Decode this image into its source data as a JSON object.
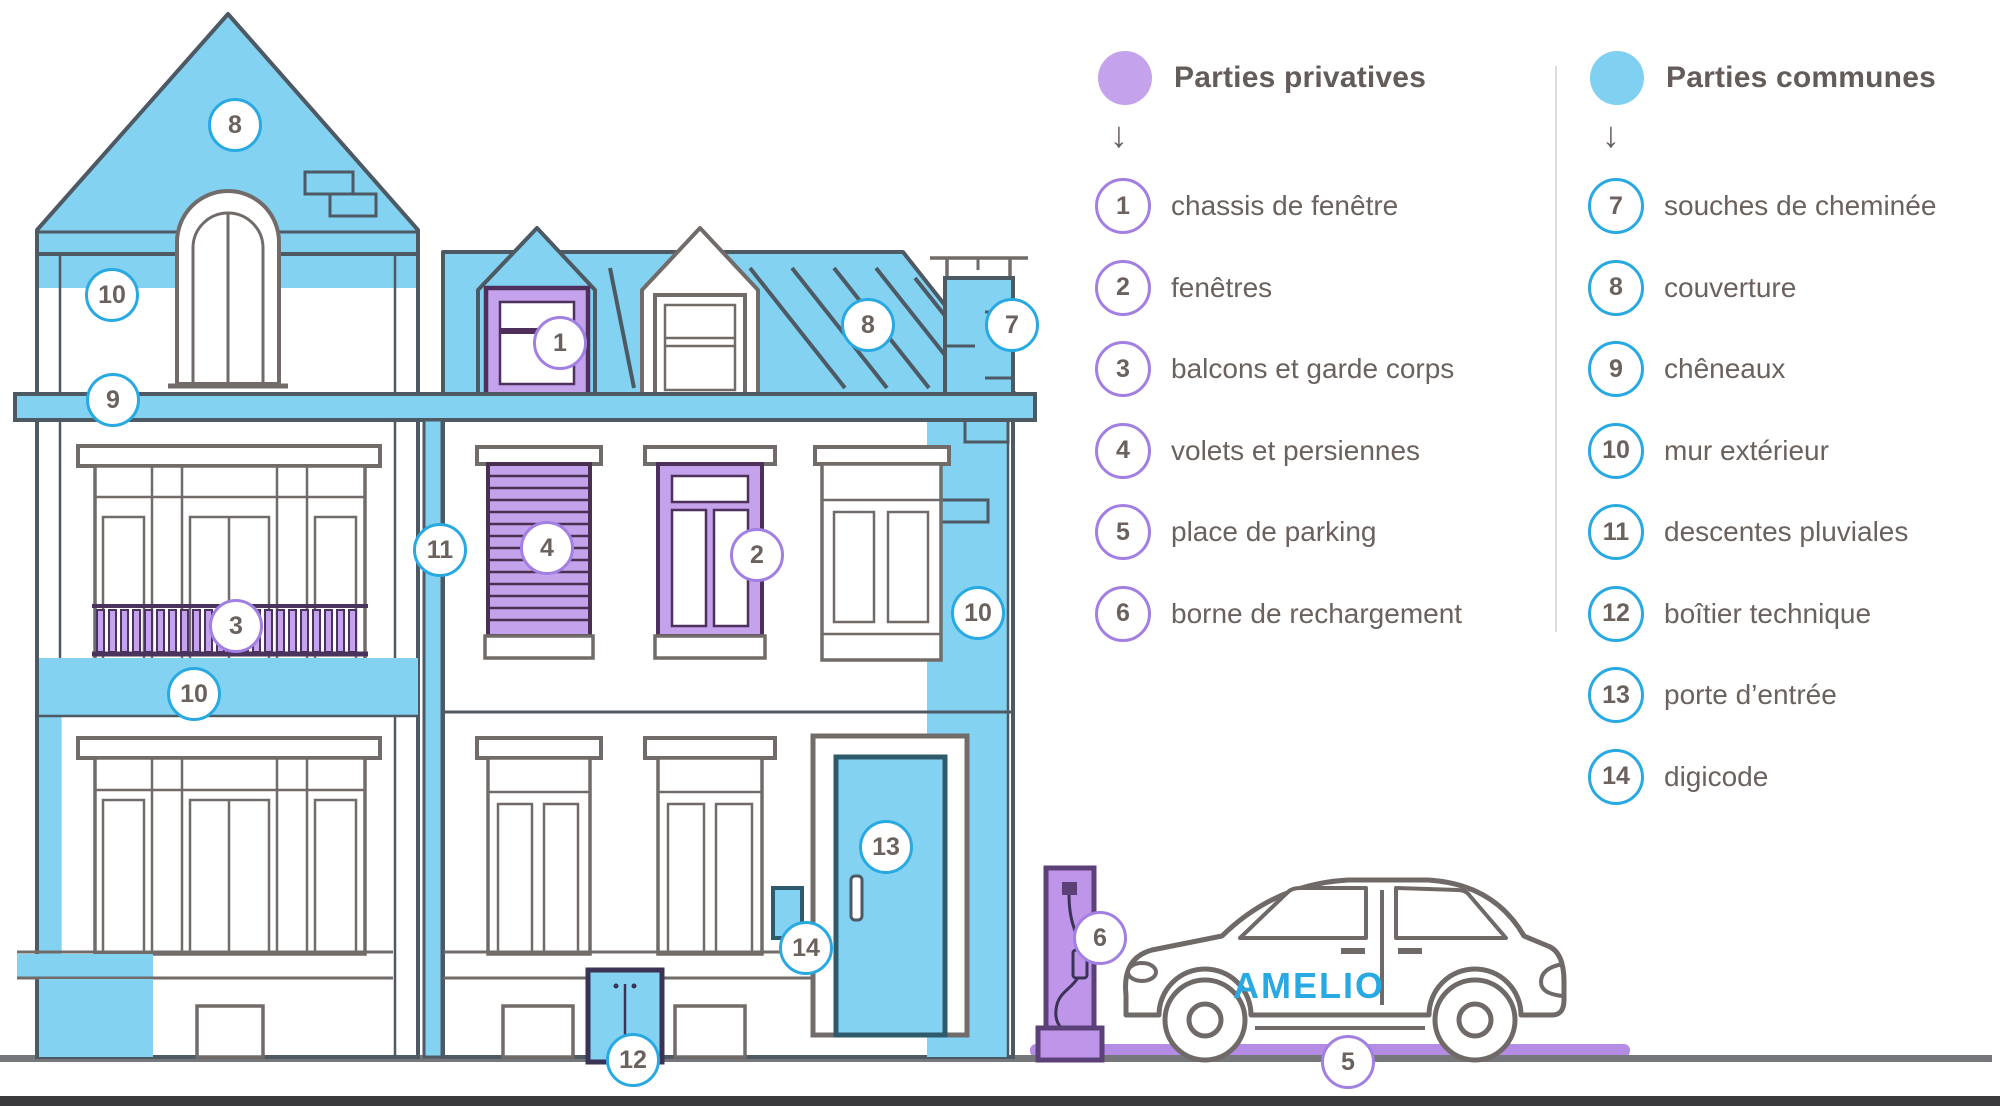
{
  "colors": {
    "common_blue": "#84D2F2",
    "private_purple": "#C5A3EC",
    "ring_blue": "#29A9E2",
    "ring_purple": "#A27FE3",
    "outline_slate": "#4D5A64",
    "outline_gray": "#716C69",
    "text_gray": "#6B625E",
    "brand_blue": "#29A9E1",
    "parking_purple": "#B58CE4"
  },
  "legend": {
    "private": {
      "title": "Parties privatives",
      "arrow": "↓",
      "items": [
        {
          "n": "1",
          "label": "chassis de fenêtre"
        },
        {
          "n": "2",
          "label": "fenêtres"
        },
        {
          "n": "3",
          "label": "balcons et garde corps"
        },
        {
          "n": "4",
          "label": "volets et persiennes"
        },
        {
          "n": "5",
          "label": "place de parking"
        },
        {
          "n": "6",
          "label": "borne de rechargement"
        }
      ]
    },
    "common": {
      "title": "Parties communes",
      "arrow": "↓",
      "items": [
        {
          "n": "7",
          "label": "souches de cheminée"
        },
        {
          "n": "8",
          "label": "couverture"
        },
        {
          "n": "9",
          "label": "chêneaux"
        },
        {
          "n": "10",
          "label": "mur extérieur"
        },
        {
          "n": "11",
          "label": "descentes pluviales"
        },
        {
          "n": "12",
          "label": "boîtier technique"
        },
        {
          "n": "13",
          "label": "porte d’entrée"
        },
        {
          "n": "14",
          "label": "digicode"
        }
      ]
    }
  },
  "car": {
    "brand": "AMELIO"
  },
  "badges": [
    {
      "n": "1",
      "x": 560,
      "y": 343,
      "t": "private"
    },
    {
      "n": "2",
      "x": 757,
      "y": 555,
      "t": "private"
    },
    {
      "n": "3",
      "x": 236,
      "y": 626,
      "t": "private"
    },
    {
      "n": "4",
      "x": 547,
      "y": 548,
      "t": "private"
    },
    {
      "n": "5",
      "x": 1348,
      "y": 1062,
      "t": "private"
    },
    {
      "n": "6",
      "x": 1100,
      "y": 938,
      "t": "private"
    },
    {
      "n": "7",
      "x": 1012,
      "y": 325,
      "t": "common"
    },
    {
      "n": "8",
      "x": 235,
      "y": 125,
      "t": "common"
    },
    {
      "n": "8",
      "x": 868,
      "y": 325,
      "t": "common"
    },
    {
      "n": "9",
      "x": 113,
      "y": 400,
      "t": "common"
    },
    {
      "n": "10",
      "x": 112,
      "y": 295,
      "t": "common"
    },
    {
      "n": "10",
      "x": 194,
      "y": 694,
      "t": "common"
    },
    {
      "n": "10",
      "x": 978,
      "y": 613,
      "t": "common"
    },
    {
      "n": "11",
      "x": 440,
      "y": 550,
      "t": "common"
    },
    {
      "n": "12",
      "x": 633,
      "y": 1060,
      "t": "common"
    },
    {
      "n": "13",
      "x": 886,
      "y": 847,
      "t": "common"
    },
    {
      "n": "14",
      "x": 806,
      "y": 948,
      "t": "common"
    }
  ]
}
